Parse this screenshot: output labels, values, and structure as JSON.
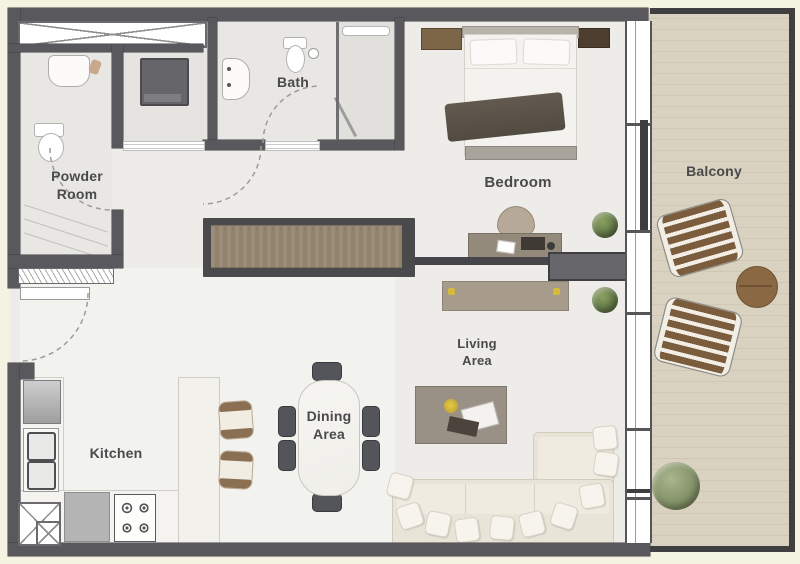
{
  "rooms": {
    "powder_room": {
      "line1": "Powder",
      "line2": "Room"
    },
    "bath": {
      "label": "Bath"
    },
    "bedroom": {
      "label": "Bedroom"
    },
    "balcony": {
      "label": "Balcony"
    },
    "kitchen": {
      "label": "Kitchen"
    },
    "dining_area": {
      "line1": "Dining",
      "line2": "Area"
    },
    "living_area": {
      "line1": "Living",
      "line2": "Area"
    }
  },
  "colors": {
    "canvas_background": "#f4f2e1",
    "wall": "#59595d",
    "interior_floor": "#edece8",
    "wet_room_floor": "#e8e7e3",
    "balcony_floor": "#ebe7dc",
    "counter": "#f4f3f0",
    "wood_dark": "#7b5d3e",
    "wood_light": "#9a8b76",
    "sofa_cream": "#e9e4d8",
    "plant_green": "#647a49",
    "label_text": "#4a4a4c"
  }
}
